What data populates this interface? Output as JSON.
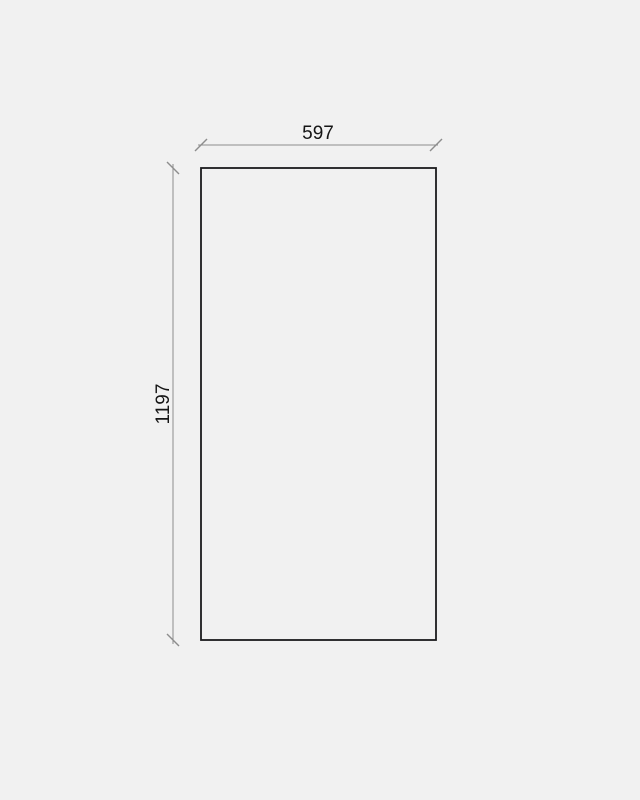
{
  "page": {
    "background": "#f1f1f1"
  },
  "drawing": {
    "type": "dimension-diagram",
    "colors": {
      "outline": "#1b1b1d",
      "dimension": "#8d8d8d",
      "text": "#151515"
    },
    "dimensions": {
      "width": {
        "label": "597",
        "value": 597
      },
      "height": {
        "label": "1197",
        "value": 1197
      }
    }
  }
}
